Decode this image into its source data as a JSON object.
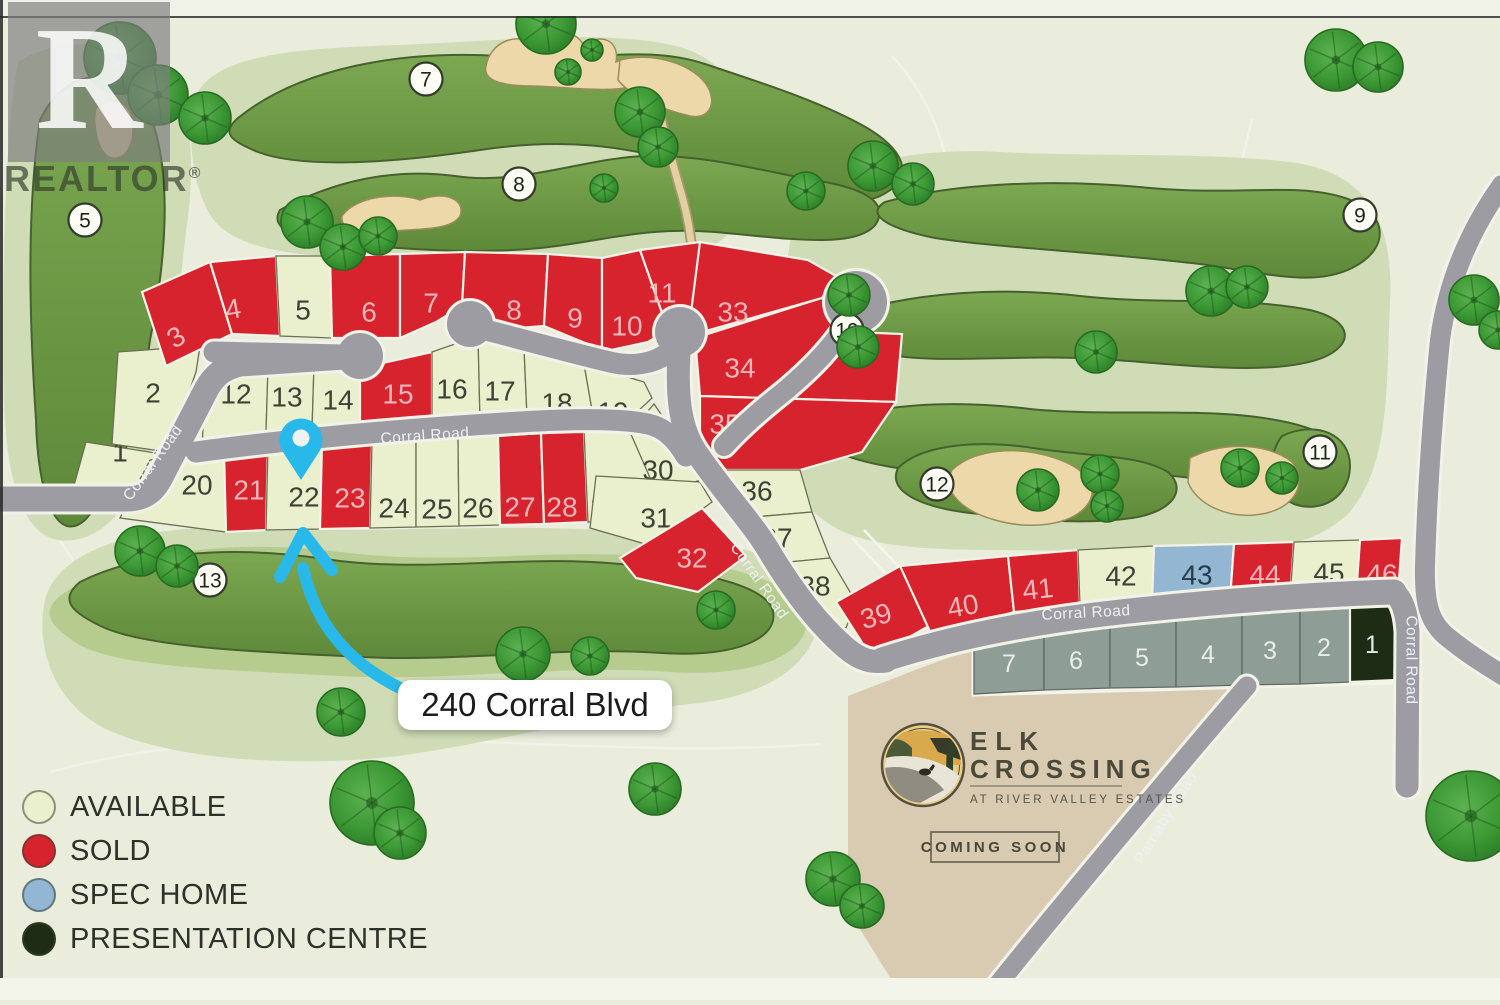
{
  "map": {
    "title_hint": "Elk Crossing lot map",
    "address_label": "240 Corral Blvd",
    "watermark": {
      "logo_letter": "R",
      "text": "REALTOR",
      "reg_mark": "®"
    },
    "branding": {
      "line1": "ELK",
      "line2": "CROSSING",
      "subtitle": "AT RIVER VALLEY ESTATES",
      "badge": "COMING SOON"
    },
    "legend": {
      "items": [
        {
          "key": "available",
          "label": "AVAILABLE",
          "color": "#eaefce"
        },
        {
          "key": "sold",
          "label": "SOLD",
          "color": "#d7232e"
        },
        {
          "key": "spec-home",
          "label": "SPEC HOME",
          "color": "#93b7d3"
        },
        {
          "key": "presentation-centre",
          "label": "PRESENTATION CENTRE",
          "color": "#1e2b15"
        }
      ]
    },
    "colors": {
      "background": "#eaecdc",
      "rough": "#cfdcb6",
      "rough_mid": "#b6cc8e",
      "fairway": "#6e9a45",
      "bunker": "#ecd8a8",
      "road": "#9c9ca2",
      "parcel": "#d9cbb1",
      "accent_blue": "#29b8ea",
      "status": {
        "a": {
          "fill": "#eaefce",
          "stroke": "#6a7052",
          "text": "#3d4237"
        },
        "r": {
          "fill": "#d7232e",
          "stroke": "#f3f3e8",
          "text": "#f3b6b9"
        },
        "b": {
          "fill": "#93b7d3",
          "stroke": "#f3f3e8",
          "text": "#263c4a"
        },
        "g": {
          "fill": "#8e9d96",
          "stroke": "#5f6b65",
          "text": "#e8eee8"
        },
        "k": {
          "fill": "#1e2b15",
          "stroke": "#f3f3e8",
          "text": "#e6ebe2"
        }
      }
    },
    "road_labels": [
      {
        "t": "Corral Road",
        "x": 153,
        "y": 463,
        "r": -54
      },
      {
        "t": "Corral Road",
        "x": 425,
        "y": 436,
        "r": -4
      },
      {
        "t": "Corral Road",
        "x": 759,
        "y": 581,
        "r": 55
      },
      {
        "t": "Corral Road",
        "x": 1086,
        "y": 613,
        "r": -3
      },
      {
        "t": "Corral Road",
        "x": 1411,
        "y": 660,
        "r": 90
      },
      {
        "t": "Parnaby Road",
        "x": 1166,
        "y": 818,
        "r": -58
      }
    ],
    "golf_holes": [
      {
        "n": "5",
        "x": 85,
        "y": 220
      },
      {
        "n": "7",
        "x": 426,
        "y": 79
      },
      {
        "n": "8",
        "x": 519,
        "y": 184
      },
      {
        "n": "9",
        "x": 1360,
        "y": 215
      },
      {
        "n": "10",
        "x": 847,
        "y": 330
      },
      {
        "n": "11",
        "x": 1320,
        "y": 452
      },
      {
        "n": "12",
        "x": 937,
        "y": 484
      },
      {
        "n": "13",
        "x": 210,
        "y": 580
      }
    ],
    "lots": [
      {
        "n": "1",
        "s": "a",
        "p": "86,442 168,455 150,516 70,500",
        "x": 120,
        "y": 452
      },
      {
        "n": "2",
        "s": "a",
        "p": "118,352 200,346 196,372 168,452 112,444",
        "x": 153,
        "y": 393
      },
      {
        "n": "3",
        "s": "r",
        "p": "142,292 210,262 232,334 166,366",
        "x": 176,
        "y": 337,
        "rot": -32
      },
      {
        "n": "4",
        "s": "r",
        "p": "210,262 276,256 280,336 232,334",
        "x": 233,
        "y": 309,
        "rot": -10
      },
      {
        "n": "5",
        "s": "a",
        "p": "276,256 330,256 332,338 280,336",
        "x": 303,
        "y": 310
      },
      {
        "n": "6",
        "s": "r",
        "p": "330,256 400,254 400,338 332,338",
        "x": 369,
        "y": 312
      },
      {
        "n": "7",
        "s": "r",
        "p": "400,254 465,252 462,306 436,322 400,338",
        "x": 431,
        "y": 303
      },
      {
        "n": "8",
        "s": "r",
        "p": "465,252 548,254 544,326 494,330 462,306",
        "x": 514,
        "y": 310
      },
      {
        "n": "9",
        "s": "r",
        "p": "548,254 602,258 602,350 544,326",
        "x": 575,
        "y": 318
      },
      {
        "n": "10",
        "s": "r",
        "p": "602,258 640,250 668,330 648,342 602,352",
        "x": 627,
        "y": 326
      },
      {
        "n": "11",
        "s": "r",
        "p": "640,250 700,242 692,320 668,330",
        "x": 662,
        "y": 293
      },
      {
        "n": "12",
        "s": "a",
        "p": "206,370 268,367 266,432 202,448",
        "x": 236,
        "y": 394
      },
      {
        "n": "13",
        "s": "a",
        "p": "268,367 314,365 312,430 266,432",
        "x": 287,
        "y": 397
      },
      {
        "n": "14",
        "s": "a",
        "p": "314,365 360,368 360,428 312,430",
        "x": 338,
        "y": 400
      },
      {
        "n": "15",
        "s": "r",
        "p": "360,368 432,352 432,424 360,428",
        "x": 398,
        "y": 394
      },
      {
        "n": "16",
        "s": "a",
        "p": "432,352 478,336 480,420 432,424",
        "x": 452,
        "y": 389
      },
      {
        "n": "17",
        "s": "a",
        "p": "478,336 524,348 527,416 480,420",
        "x": 500,
        "y": 391
      },
      {
        "n": "18",
        "s": "a",
        "p": "524,348 584,364 592,410 527,416",
        "x": 557,
        "y": 403
      },
      {
        "n": "19",
        "s": "a",
        "p": "584,364 644,382 652,398 622,426 592,410",
        "x": 613,
        "y": 412
      },
      {
        "n": "20",
        "s": "a",
        "p": "150,460 224,450 226,532 120,518",
        "x": 197,
        "y": 485
      },
      {
        "n": "21",
        "s": "r",
        "p": "224,450 268,447 266,530 226,532",
        "x": 249,
        "y": 490
      },
      {
        "n": "22",
        "s": "a",
        "p": "268,447 322,444 320,529 266,530",
        "x": 304,
        "y": 497
      },
      {
        "n": "23",
        "s": "r",
        "p": "322,444 372,442 370,528 320,529",
        "x": 350,
        "y": 498
      },
      {
        "n": "24",
        "s": "a",
        "p": "372,442 416,440 416,527 370,528",
        "x": 394,
        "y": 508
      },
      {
        "n": "25",
        "s": "a",
        "p": "416,440 458,438 459,526 416,527",
        "x": 437,
        "y": 509
      },
      {
        "n": "26",
        "s": "a",
        "p": "458,438 498,436 500,525 459,526",
        "x": 478,
        "y": 508
      },
      {
        "n": "27",
        "s": "r",
        "p": "498,436 541,433 544,524 500,525",
        "x": 520,
        "y": 507
      },
      {
        "n": "28",
        "s": "r",
        "p": "541,433 584,430 588,522 544,524",
        "x": 562,
        "y": 507
      },
      {
        "n": "29",
        "s": "a",
        "p": "584,430 624,427 652,456 644,518 588,522",
        "x": 606,
        "y": 507
      },
      {
        "n": "30",
        "s": "a",
        "p": "630,432 654,404 694,462 700,480 658,496",
        "x": 658,
        "y": 470
      },
      {
        "n": "31",
        "s": "a",
        "p": "596,476 700,482 712,502 652,546 590,528",
        "x": 656,
        "y": 518
      },
      {
        "n": "32",
        "s": "r",
        "p": "620,558 702,508 746,556 698,592 636,578",
        "x": 692,
        "y": 558
      },
      {
        "n": "33",
        "s": "r",
        "p": "700,242 808,260 836,276 822,298 688,336",
        "x": 733,
        "y": 312
      },
      {
        "n": "34",
        "s": "r",
        "p": "695,338 822,298 852,332 902,334 896,402 700,396",
        "x": 740,
        "y": 368
      },
      {
        "n": "35",
        "s": "r",
        "p": "700,396 896,402 862,452 800,470 726,470 700,444",
        "x": 725,
        "y": 424
      },
      {
        "n": "36",
        "s": "a",
        "p": "726,470 800,470 812,512 742,518",
        "x": 757,
        "y": 491
      },
      {
        "n": "37",
        "s": "a",
        "p": "742,518 812,512 830,558 768,564",
        "x": 777,
        "y": 538
      },
      {
        "n": "38",
        "s": "a",
        "p": "768,564 830,558 856,602 846,628 800,616",
        "x": 815,
        "y": 586
      },
      {
        "n": "39",
        "s": "r",
        "p": "836,602 900,566 936,622 872,658",
        "x": 876,
        "y": 616,
        "rot": -16
      },
      {
        "n": "40",
        "s": "r",
        "p": "900,566 1008,556 1014,612 932,636",
        "x": 963,
        "y": 606,
        "rot": -10
      },
      {
        "n": "41",
        "s": "r",
        "p": "1008,556 1078,550 1080,606 1014,612",
        "x": 1038,
        "y": 589,
        "rot": -6
      },
      {
        "n": "42",
        "s": "a",
        "p": "1078,550 1154,546 1152,602 1080,606",
        "x": 1121,
        "y": 576
      },
      {
        "n": "43",
        "s": "b",
        "p": "1154,546 1234,544 1230,600 1152,602",
        "x": 1197,
        "y": 575
      },
      {
        "n": "44",
        "s": "r",
        "p": "1234,544 1294,542 1290,598 1230,600",
        "x": 1265,
        "y": 575
      },
      {
        "n": "45",
        "s": "a",
        "p": "1294,542 1360,540 1356,596 1290,598",
        "x": 1329,
        "y": 573
      },
      {
        "n": "46",
        "s": "r",
        "p": "1360,540 1402,538 1398,594 1356,596",
        "x": 1382,
        "y": 574
      },
      {
        "n": "7",
        "s": "g",
        "p": "974,642 1044,634 1044,690 974,694",
        "x": 1009,
        "y": 664
      },
      {
        "n": "6",
        "s": "g",
        "p": "1044,634 1110,628 1110,688 1044,690",
        "x": 1076,
        "y": 661
      },
      {
        "n": "5",
        "s": "g",
        "p": "1110,628 1176,621 1176,687 1110,688",
        "x": 1142,
        "y": 658
      },
      {
        "n": "4",
        "s": "g",
        "p": "1176,621 1242,615 1242,685 1176,687",
        "x": 1208,
        "y": 655
      },
      {
        "n": "3",
        "s": "g",
        "p": "1242,615 1300,610 1300,684 1242,685",
        "x": 1270,
        "y": 651
      },
      {
        "n": "2",
        "s": "g",
        "p": "1300,610 1350,606 1350,682 1300,684",
        "x": 1324,
        "y": 648
      },
      {
        "n": "1",
        "s": "k",
        "p": "1350,606 1396,600 1396,680 1350,682",
        "x": 1372,
        "y": 645
      }
    ],
    "trees": [
      [
        120,
        58,
        36
      ],
      [
        158,
        95,
        30
      ],
      [
        205,
        118,
        26
      ],
      [
        546,
        24,
        30
      ],
      [
        568,
        72,
        13
      ],
      [
        592,
        50,
        11
      ],
      [
        307,
        222,
        26
      ],
      [
        343,
        247,
        23
      ],
      [
        378,
        236,
        19
      ],
      [
        640,
        112,
        25
      ],
      [
        658,
        147,
        20
      ],
      [
        604,
        188,
        14
      ],
      [
        806,
        191,
        19
      ],
      [
        873,
        166,
        25
      ],
      [
        913,
        184,
        21
      ],
      [
        1336,
        60,
        31
      ],
      [
        1378,
        67,
        25
      ],
      [
        1211,
        291,
        25
      ],
      [
        1247,
        287,
        21
      ],
      [
        849,
        295,
        21
      ],
      [
        858,
        347,
        21
      ],
      [
        1096,
        352,
        21
      ],
      [
        1038,
        490,
        21
      ],
      [
        1100,
        474,
        19
      ],
      [
        1107,
        506,
        16
      ],
      [
        1240,
        468,
        19
      ],
      [
        1282,
        478,
        16
      ],
      [
        140,
        551,
        25
      ],
      [
        177,
        566,
        21
      ],
      [
        523,
        654,
        27
      ],
      [
        590,
        656,
        19
      ],
      [
        716,
        610,
        19
      ],
      [
        341,
        712,
        24
      ],
      [
        372,
        803,
        42
      ],
      [
        400,
        833,
        26
      ],
      [
        655,
        789,
        26
      ],
      [
        833,
        879,
        27
      ],
      [
        862,
        906,
        22
      ],
      [
        1471,
        816,
        45
      ],
      [
        1474,
        300,
        25
      ],
      [
        1498,
        330,
        19
      ]
    ]
  }
}
